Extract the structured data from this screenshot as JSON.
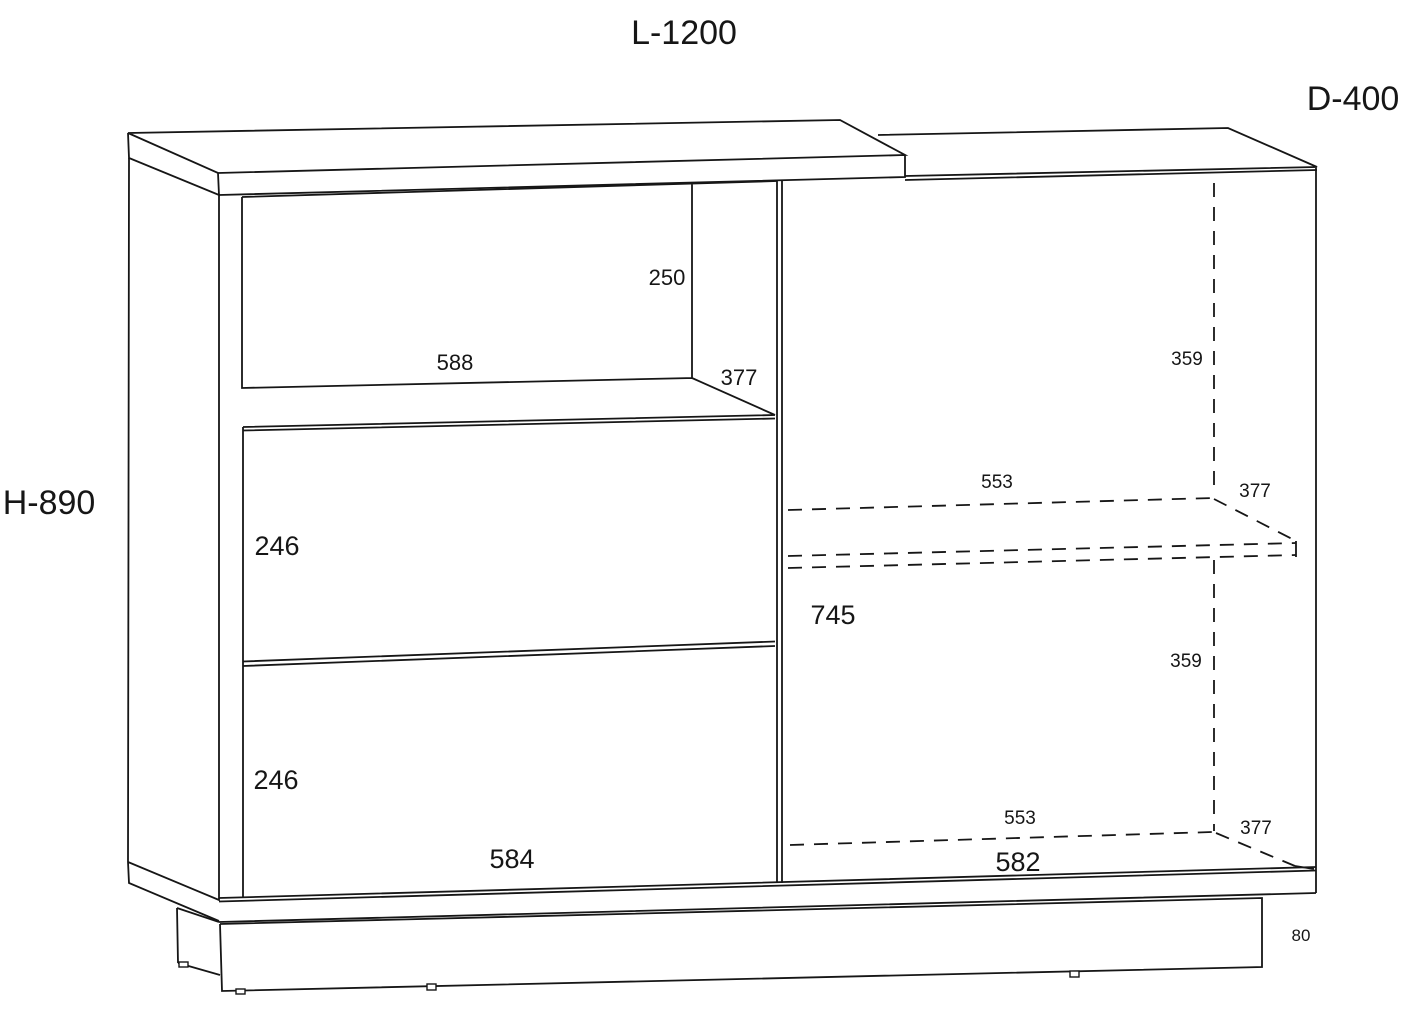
{
  "page": {
    "background": "#ffffff",
    "line_color": "#161616"
  },
  "drawing": {
    "overall": {
      "length": "L-1200",
      "depth": "D-400",
      "height": "H-890"
    },
    "dims": {
      "niche_height": "250",
      "niche_width": "588",
      "niche_depth": "377",
      "right_upper_gap": "359",
      "shelf_width": "553",
      "shelf_depth": "377",
      "upper_drawer_height": "246",
      "right_inner_height": "745",
      "right_lower_gap": "359",
      "lower_drawer_height": "246",
      "bottom_inner_width": "553",
      "bottom_inner_depth": "377",
      "drawer_front_width": "584",
      "door_front_width": "582",
      "plinth_height": "80"
    }
  }
}
